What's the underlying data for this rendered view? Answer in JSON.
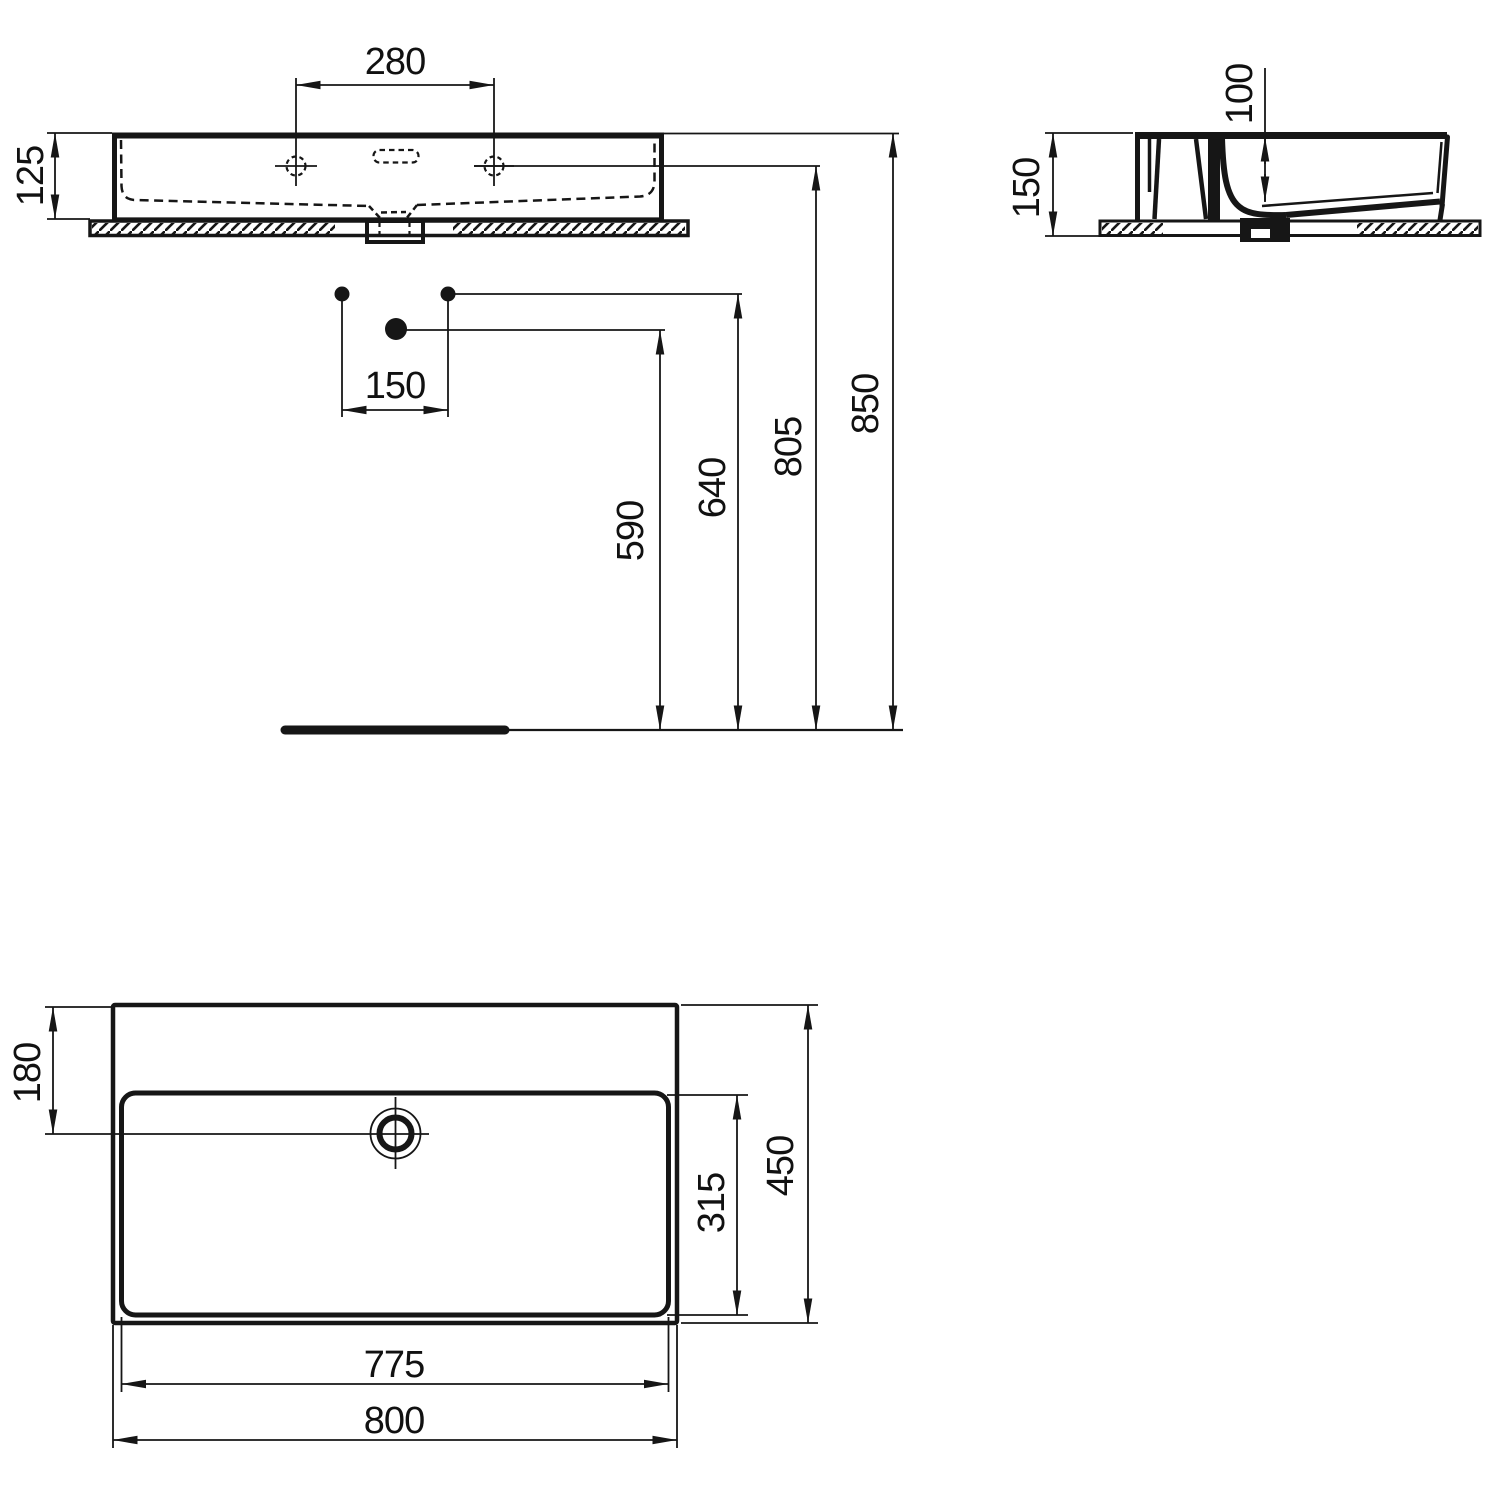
{
  "meta": {
    "title": "Washbasin technical dimension drawing",
    "description": "Three orthographic views (front elevation, side section, plan) of a rectangular wall-mounted washbasin with millimetre dimensions",
    "units": "mm",
    "view_names": {
      "front": "front elevation",
      "side": "side section",
      "plan": "plan view"
    }
  },
  "colors": {
    "line": "#161616",
    "background": "#ffffff"
  },
  "dims": {
    "front": {
      "tap_hole_spacing": "280",
      "basin_height": "125",
      "drain_offset": "150",
      "supply_line_height": "590",
      "drain_line_height": "640",
      "tap_hole_height": "805",
      "rim_height": "850"
    },
    "side": {
      "bowl_depth": "100",
      "mounting_height": "150"
    },
    "plan": {
      "hole_center_offset": "180",
      "bowl_front_to_back": "315",
      "overall_depth": "450",
      "bowl_width": "775",
      "overall_width": "800"
    }
  }
}
